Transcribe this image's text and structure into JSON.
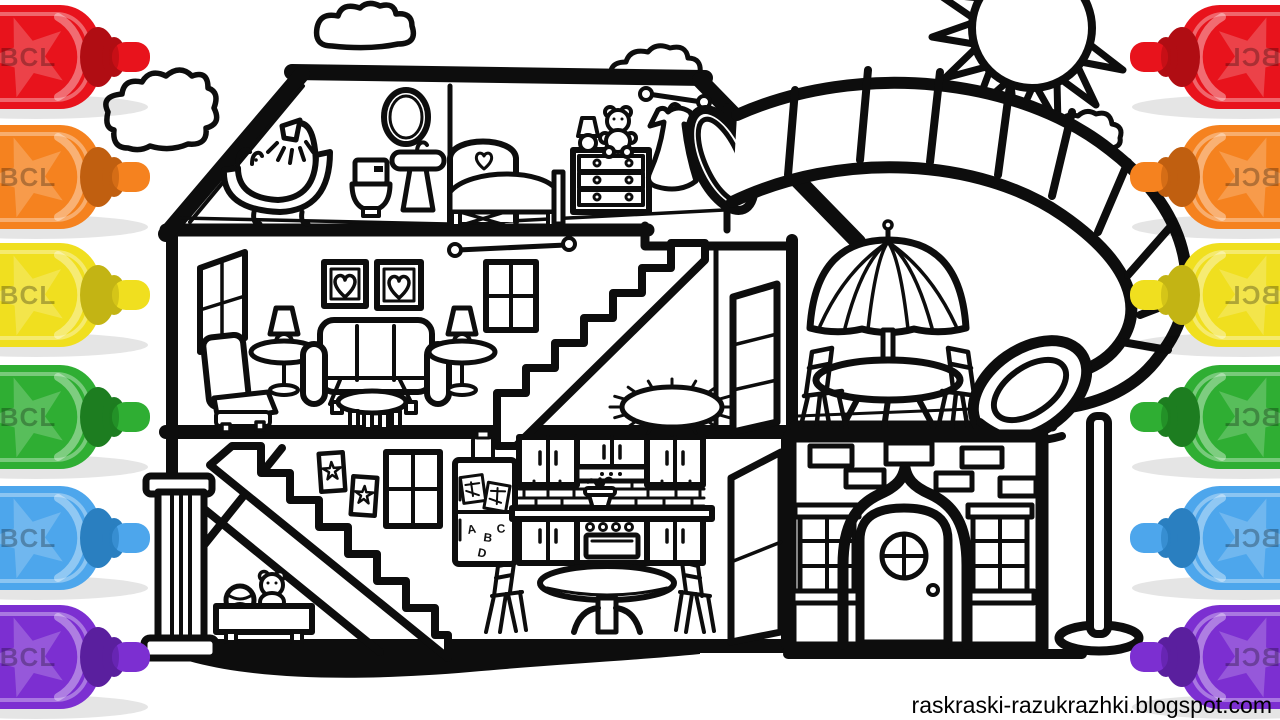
{
  "canvas": {
    "width": 1280,
    "height": 720,
    "background": "#ffffff",
    "line_color": "#0d0d0d"
  },
  "watermark": {
    "text": "raskraski-razukrazhki.blogspot.com"
  },
  "marker_label": "BCL",
  "markers": {
    "left": [
      {
        "name": "red",
        "body": "#e8131c",
        "tip": "#b00d13"
      },
      {
        "name": "orange",
        "body": "#f5821f",
        "tip": "#c05f10"
      },
      {
        "name": "yellow",
        "body": "#f0df1f",
        "tip": "#c3b414"
      },
      {
        "name": "green",
        "body": "#2fae33",
        "tip": "#1d7d20"
      },
      {
        "name": "blue",
        "body": "#4da6ec",
        "tip": "#2a7fc0"
      },
      {
        "name": "purple",
        "body": "#7c2fd1",
        "tip": "#5a1f9e"
      }
    ],
    "right": [
      {
        "name": "red",
        "body": "#e8131c",
        "tip": "#b00d13"
      },
      {
        "name": "orange",
        "body": "#f5821f",
        "tip": "#c05f10"
      },
      {
        "name": "yellow",
        "body": "#f0df1f",
        "tip": "#c3b414"
      },
      {
        "name": "green",
        "body": "#2fae33",
        "tip": "#1d7d20"
      },
      {
        "name": "blue",
        "body": "#4da6ec",
        "tip": "#2a7fc0"
      },
      {
        "name": "purple",
        "body": "#7c2fd1",
        "tip": "#5a1f9e"
      }
    ]
  },
  "fridge_magnets": [
    "A",
    "B",
    "C",
    "D"
  ],
  "scene": {
    "type": "coloring-page",
    "objects": [
      "dollhouse-cross-section",
      "water-slide",
      "sun",
      "clouds",
      "paint-markers"
    ],
    "rooms": [
      "bathroom",
      "bedroom",
      "living-room",
      "hallway",
      "patio",
      "playroom",
      "kitchen",
      "dining-area",
      "brick-entrance"
    ]
  }
}
